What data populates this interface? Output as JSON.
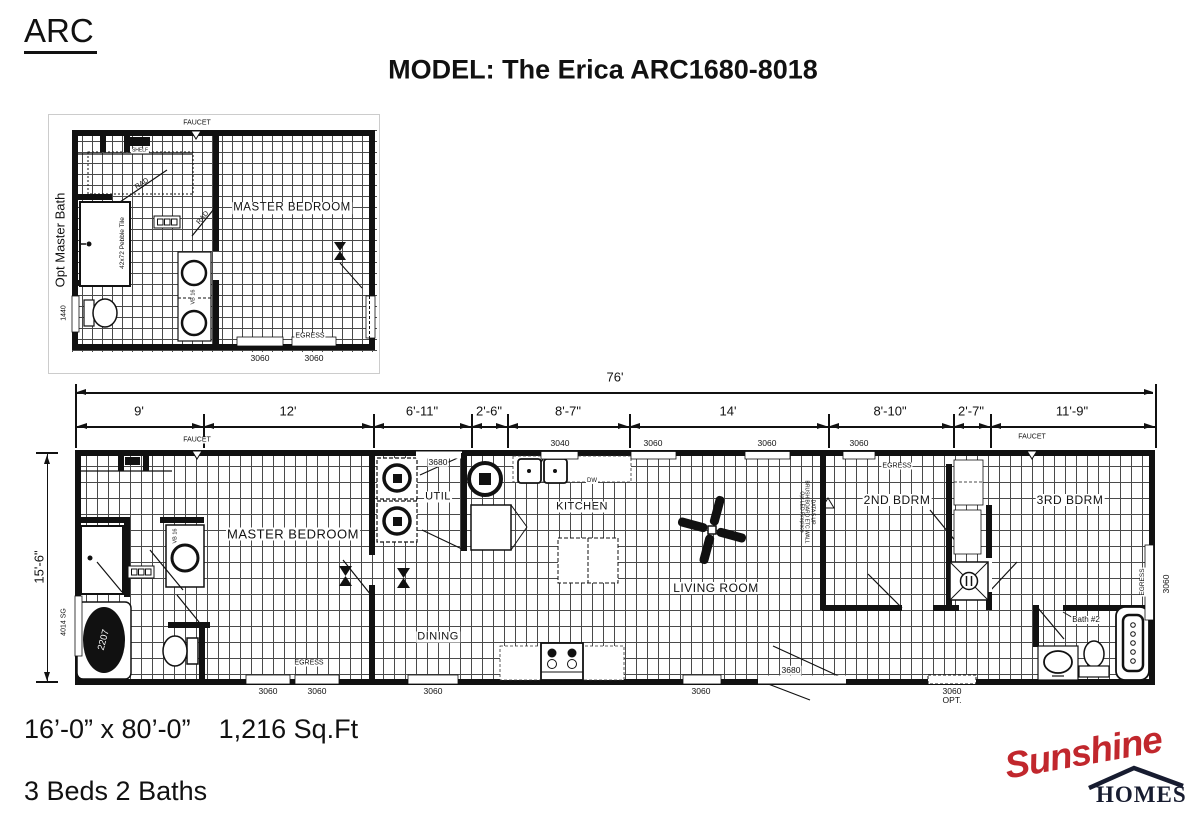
{
  "title": {
    "series": "ARC",
    "model": "MODEL: The Erica ARC1680-8018"
  },
  "dims": {
    "overall": "76'",
    "height": "15'-6\"",
    "segments": [
      "9'",
      "12'",
      "6'-11\"",
      "2'-6\"",
      "8'-7\"",
      "14'",
      "8'-10\"",
      "2'-7\"",
      "11'-9\""
    ]
  },
  "inset": {
    "side_label": "Opt Master Bath",
    "faucet": "FAUCET",
    "shelf": "SHELF",
    "rad1": "RAD",
    "rad2": "RAD",
    "tile": "42x72 Pebble Tile",
    "room": "MASTER BEDROOM",
    "vb": "VB 16",
    "w1440": "1440",
    "egress": "EGRESS",
    "w1": "3060",
    "w2": "3060"
  },
  "plan": {
    "rooms": {
      "master": "MASTER BEDROOM",
      "util": "UTIL",
      "kitchen": "KITCHEN",
      "living": "LIVING ROOM",
      "dining": "DINING",
      "bdrm2": "2ND BDRM",
      "bdrm3": "3RD BDRM",
      "bath2": "Bath #2"
    },
    "top": {
      "faucet_left": "FAUCET",
      "door": "3680",
      "w3040": "3040",
      "w1": "3060",
      "w2": "3060",
      "w3": "3060",
      "egress2": "EGRESS",
      "faucet_right": "FAUCET"
    },
    "bottom": {
      "egress": "EGRESS",
      "w1": "3060",
      "w2": "3060",
      "w3": "3060",
      "w4": "3060",
      "door": "3680",
      "opt_w": "3060",
      "opt": "OPT."
    },
    "left": {
      "w4014": "4014 SG"
    },
    "right": {
      "egress": "EGRESS",
      "w3060": "3060"
    },
    "fixtures": {
      "tub": "2207",
      "vb": "VB 16",
      "dw": "DW"
    },
    "note": {
      "l1": "DATA 5 UP",
      "l2": "BRUSH BOARD ETC WALL",
      "l3": "Opt LED Fireplace"
    }
  },
  "footer": {
    "size": "16’-0” x 80’-0”",
    "sqft": "1,216 Sq.Ft",
    "beds": "3 Beds 2 Baths"
  },
  "logo": {
    "name": "Sunshine",
    "sub": "HOMES",
    "accent": "#c1272d",
    "navy": "#171c30"
  }
}
